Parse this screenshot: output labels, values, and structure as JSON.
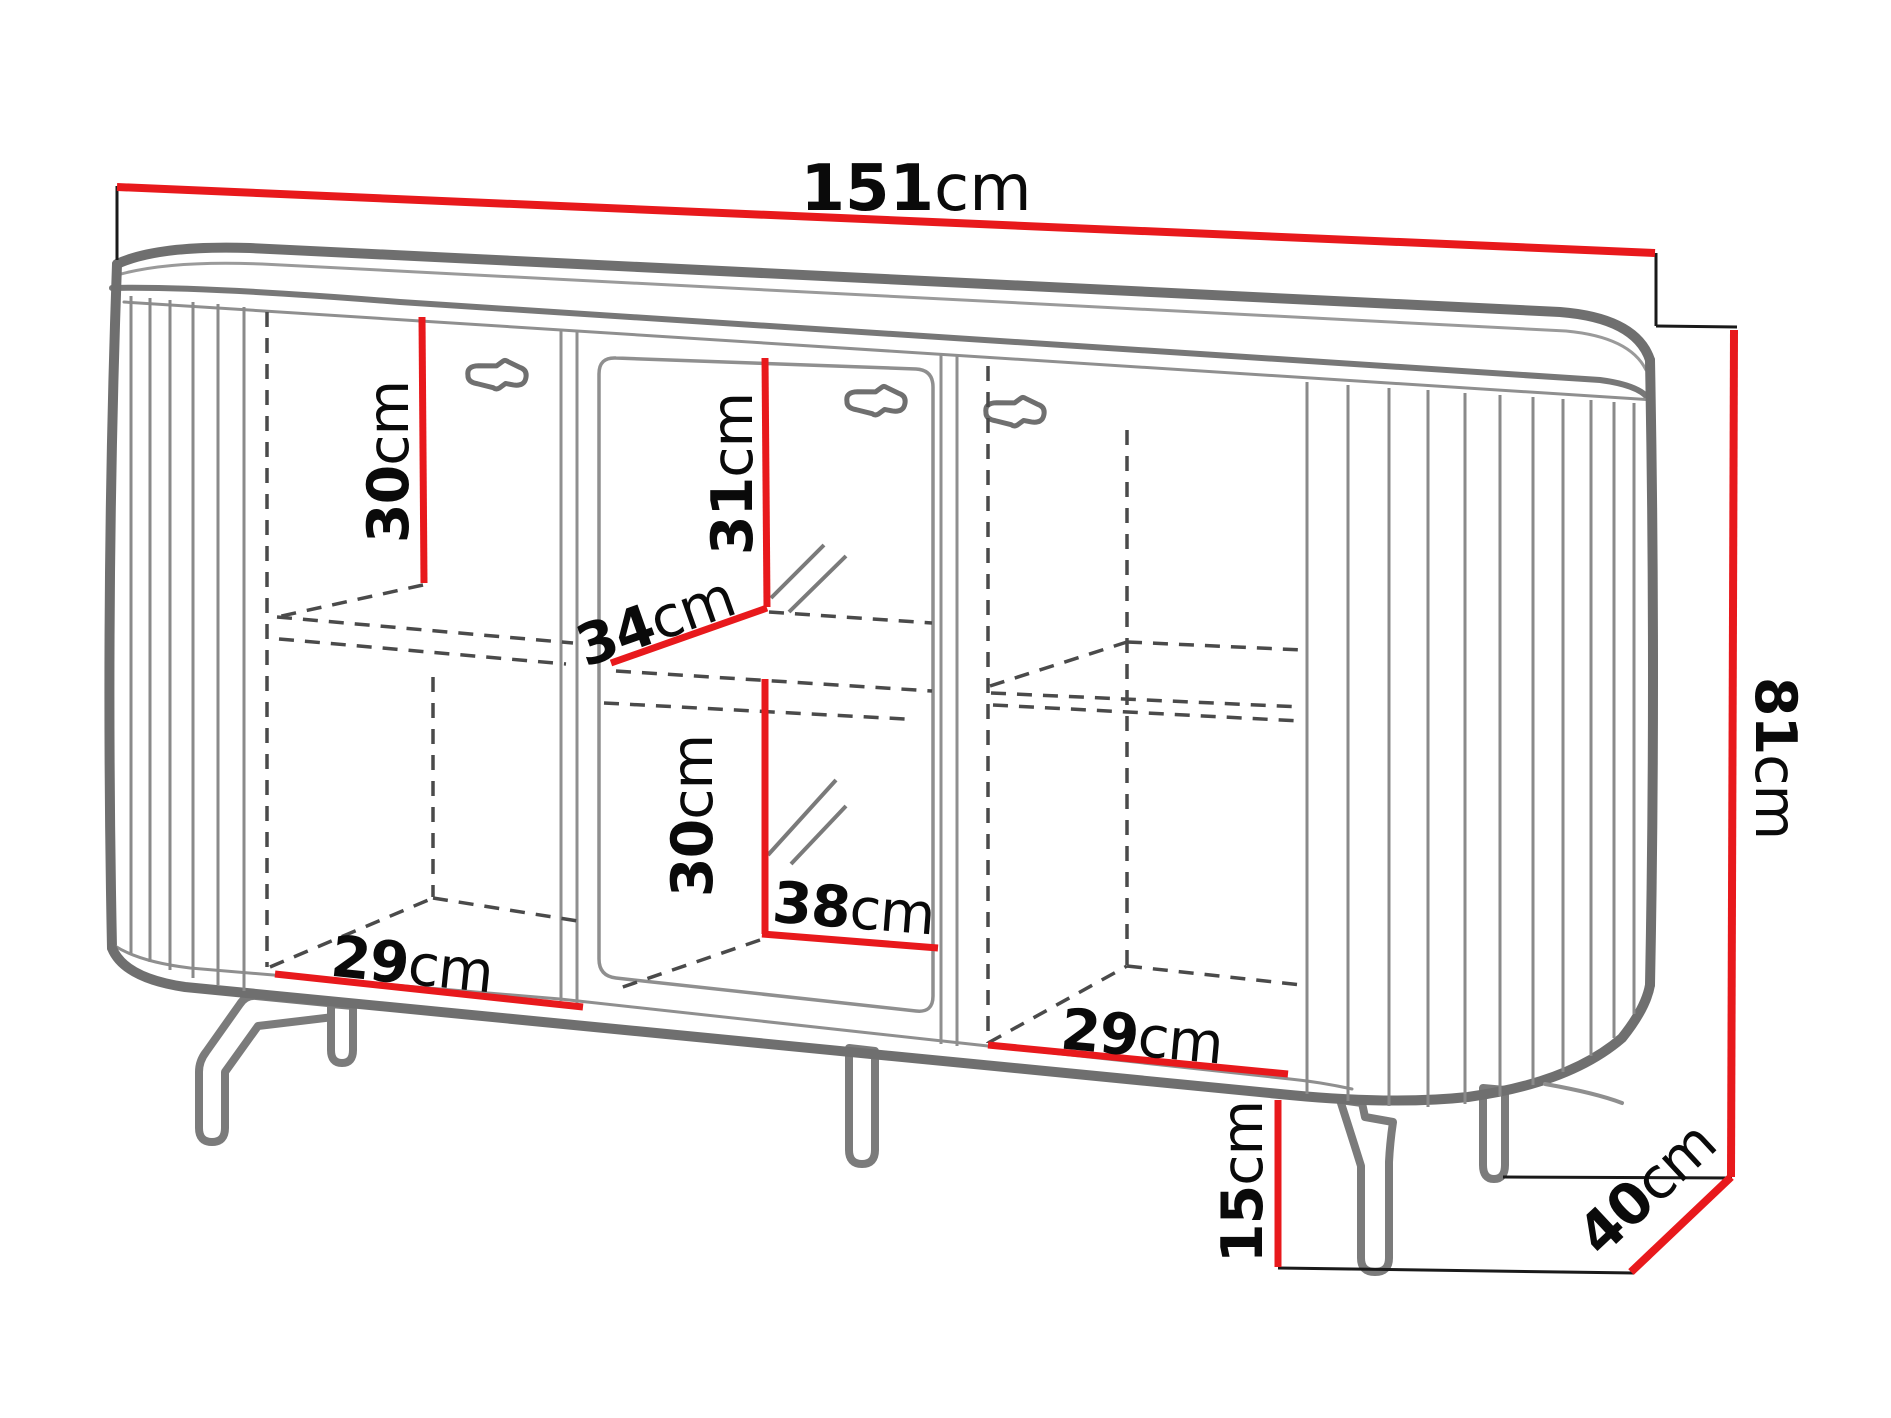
{
  "diagram": {
    "type": "furniture-dimension-drawing",
    "item": "sideboard with three doors on metal legs",
    "unit": "cm",
    "accent_color": "#e8191c",
    "outline_color": "#6f6f6f",
    "dims": {
      "width": {
        "v": "151",
        "u": "cm"
      },
      "height": {
        "v": "81",
        "u": "cm"
      },
      "depth": {
        "v": "40",
        "u": "cm"
      },
      "leg_height": {
        "v": "15",
        "u": "cm"
      },
      "left_top_compartment_height": {
        "v": "30",
        "u": "cm"
      },
      "middle_top_compartment_height": {
        "v": "31",
        "u": "cm"
      },
      "middle_shelf_depth": {
        "v": "34",
        "u": "cm"
      },
      "middle_bottom_compartment_height": {
        "v": "30",
        "u": "cm"
      },
      "middle_compartment_width": {
        "v": "38",
        "u": "cm"
      },
      "left_compartment_width": {
        "v": "29",
        "u": "cm"
      },
      "right_compartment_width": {
        "v": "29",
        "u": "cm"
      }
    }
  }
}
